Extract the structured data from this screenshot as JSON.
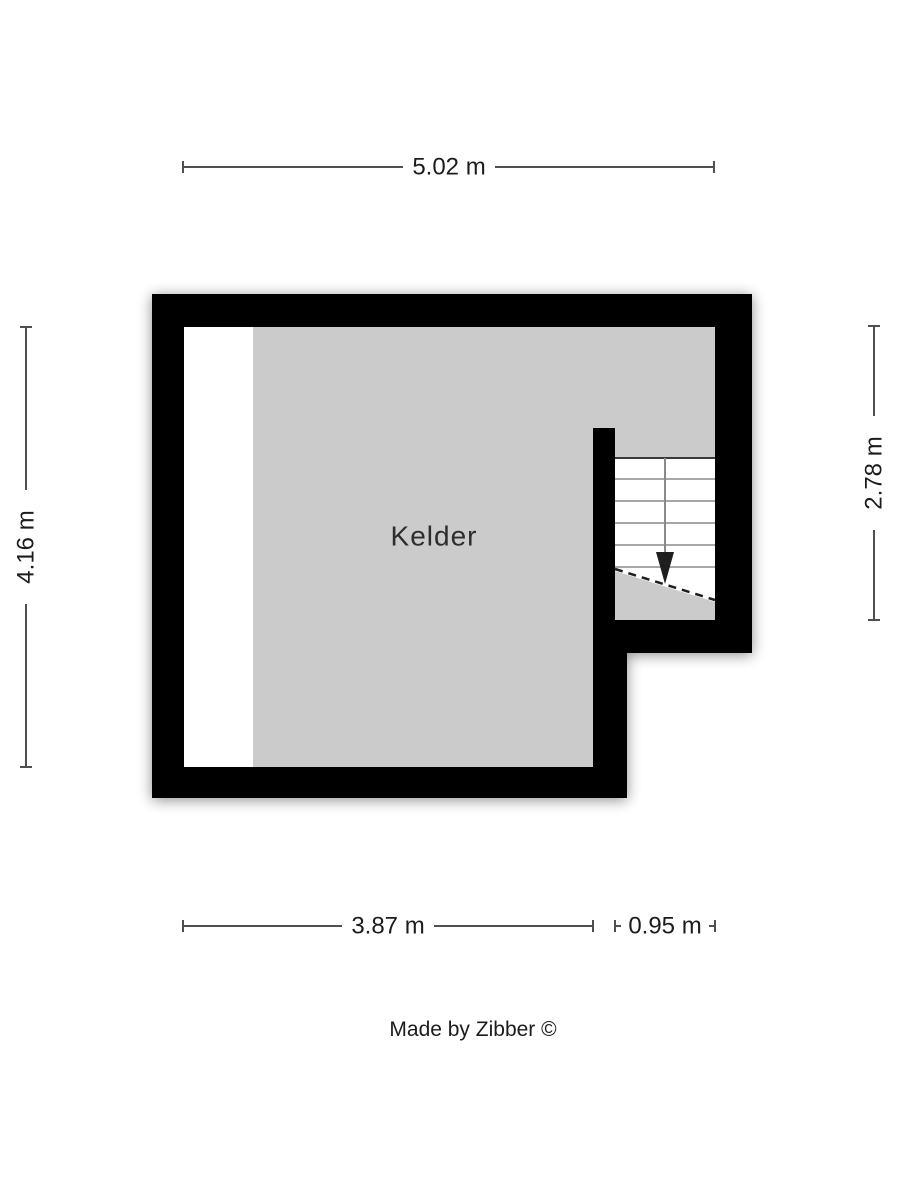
{
  "page": {
    "background": "#ffffff"
  },
  "floorplan": {
    "room_label": "Kelder",
    "credit": "Made by Zibber ©",
    "dimensions": {
      "top": "5.02 m",
      "left": "4.16 m",
      "right": "2.78 m",
      "bottom_main": "3.87 m",
      "bottom_stair": "0.95 m"
    },
    "stair": {
      "direction_icon": "down-arrow"
    },
    "colors": {
      "wall": "#000000",
      "floor": "#cbcbcb",
      "floor_light": "#ffffff",
      "dimension_line": "#4f4f4f",
      "text": "#1c1c1c"
    }
  }
}
